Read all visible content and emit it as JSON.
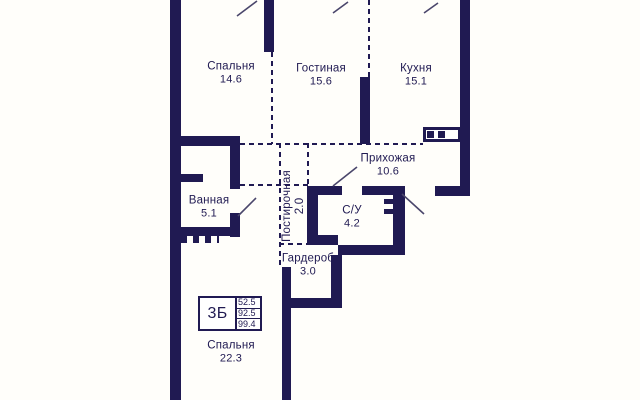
{
  "plan": {
    "rooms": [
      {
        "name": "Спальня",
        "area": "14.6"
      },
      {
        "name": "Гостиная",
        "area": "15.6"
      },
      {
        "name": "Кухня",
        "area": "15.1"
      },
      {
        "name": "Ванная",
        "area": "5.1"
      },
      {
        "name": "Прихожая",
        "area": "10.6"
      },
      {
        "name": "Постирочная",
        "area": "2.0"
      },
      {
        "name": "С/У",
        "area": "4.2"
      },
      {
        "name": "Гардероб",
        "area": "3.0"
      },
      {
        "name": "Спальня",
        "area": "22.3"
      }
    ],
    "legend": {
      "flat_type": "3Б",
      "areas": [
        "52.5",
        "92.5",
        "99.4"
      ]
    },
    "colors": {
      "wall": "#201a52",
      "text": "#201a52",
      "door_line": "#4a466b",
      "background": "#fffefa"
    }
  }
}
